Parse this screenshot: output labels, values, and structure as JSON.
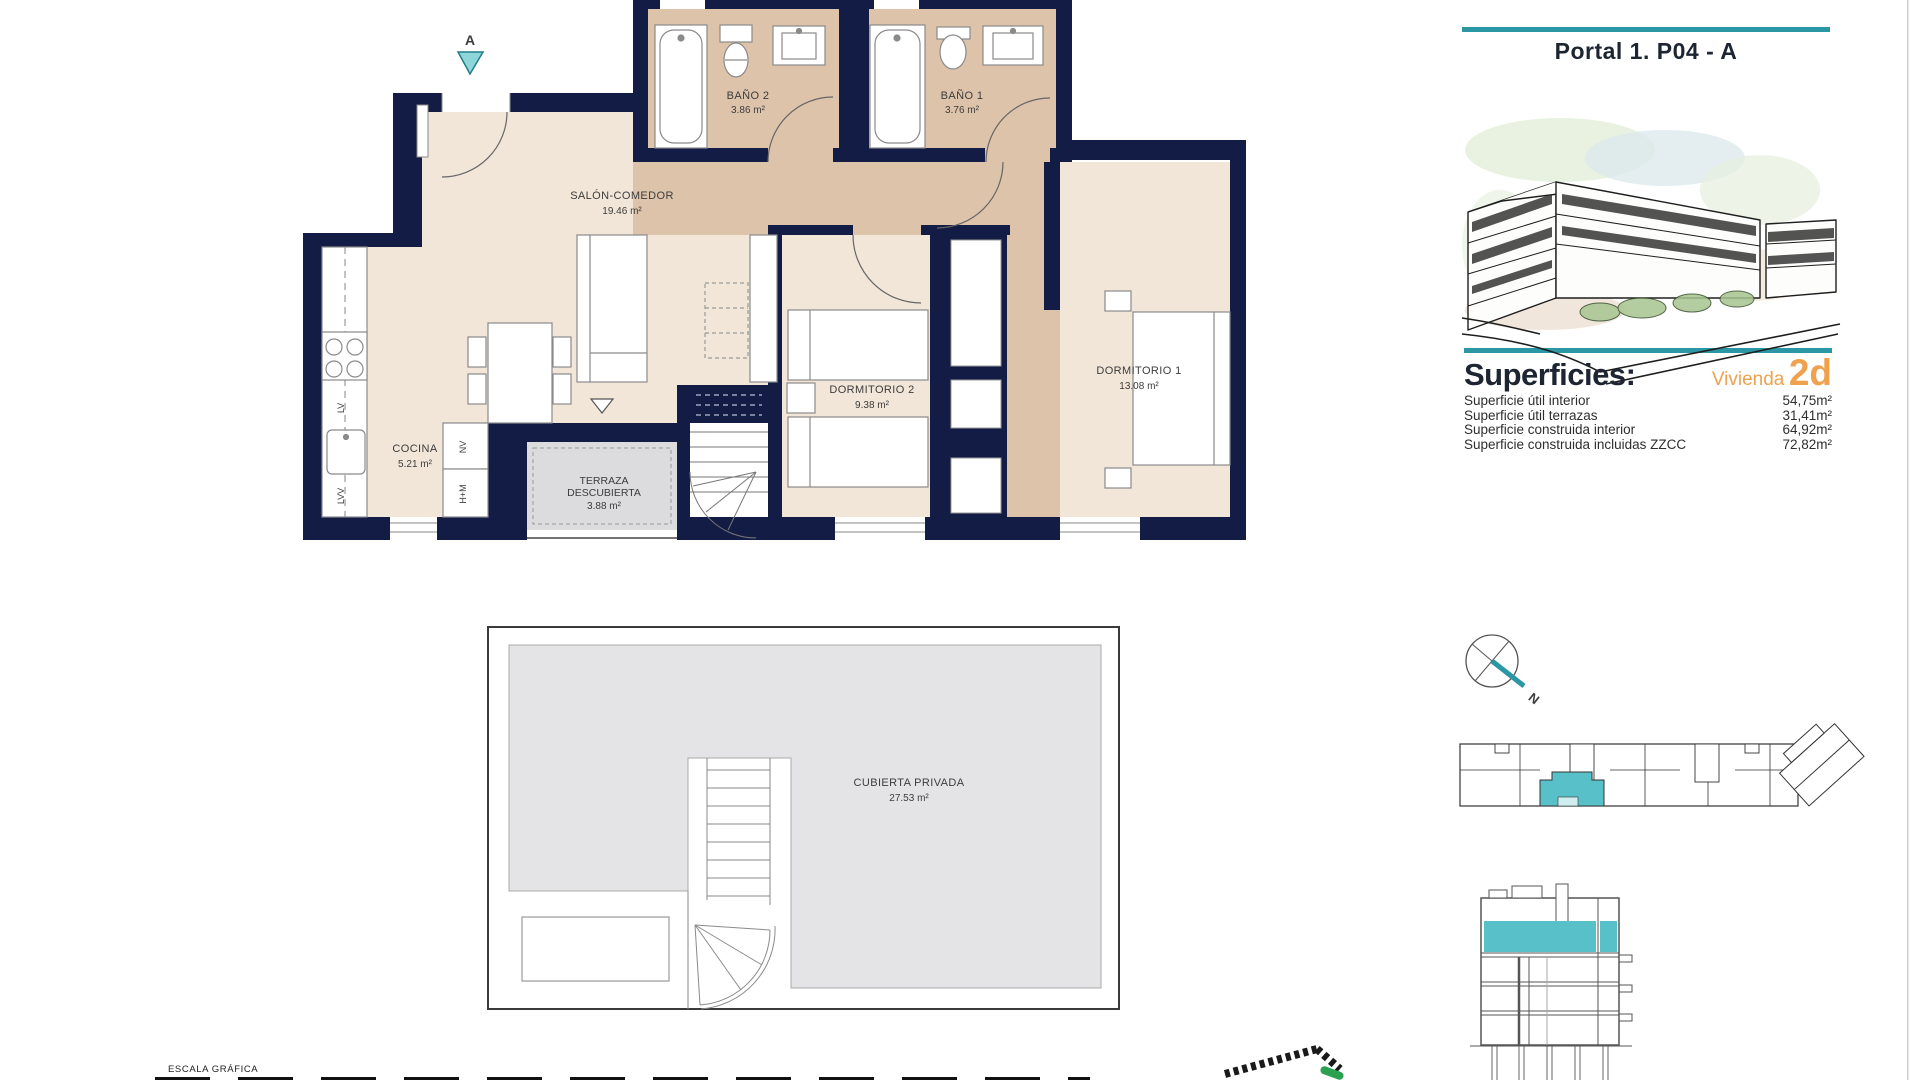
{
  "header": {
    "title": "Portal 1. P04 - A"
  },
  "superficies": {
    "heading": "Superficies:",
    "vivienda_label": "Vivienda",
    "vivienda_code": "2d",
    "rows": [
      {
        "label": "Superficie útil interior",
        "value": "54,75m²"
      },
      {
        "label": "Superficie útil terrazas",
        "value": "31,41m²"
      },
      {
        "label": "Superficie construida interior",
        "value": "64,92m²"
      },
      {
        "label": "Superficie construida incluidas ZZCC",
        "value": "72,82m²"
      }
    ]
  },
  "floor_plan": {
    "section_marker": "A",
    "rooms": {
      "salon": {
        "name": "SALÓN-COMEDOR",
        "area": "19.46 m²"
      },
      "cocina": {
        "name": "COCINA",
        "area": "5.21 m²"
      },
      "bano2": {
        "name": "BAÑO 2",
        "area": "3.86 m²"
      },
      "bano1": {
        "name": "BAÑO 1",
        "area": "3.76 m²"
      },
      "dormitorio2": {
        "name": "DORMITORIO 2",
        "area": "9.38 m²"
      },
      "dormitorio1": {
        "name": "DORMITORIO 1",
        "area": "13.08 m²"
      },
      "terraza": {
        "line1": "TERRAZA",
        "line2": "DESCUBIERTA",
        "area": "3.88 m²"
      }
    },
    "appliances": {
      "lv": "LV",
      "lvv": "LVV",
      "nv": "NV",
      "hm": "H+M"
    }
  },
  "roof_plan": {
    "name": "CUBIERTA PRIVADA",
    "area": "27.53 m²"
  },
  "compass": {
    "north": "N"
  },
  "footer": {
    "scale_label": "ESCALA GRÁFICA"
  },
  "colors": {
    "wall": "#131c45",
    "floor_light": "#f2e6d9",
    "floor_dark": "#ddc3aa",
    "terrace_gray": "#dcdcde",
    "roof_gray": "#e4e4e6",
    "accent_teal": "#2b97a4",
    "accent_teal_light": "#8fd6da",
    "highlight_orange": "#efa14d",
    "unit_fill_teal": "#57c0c8"
  }
}
